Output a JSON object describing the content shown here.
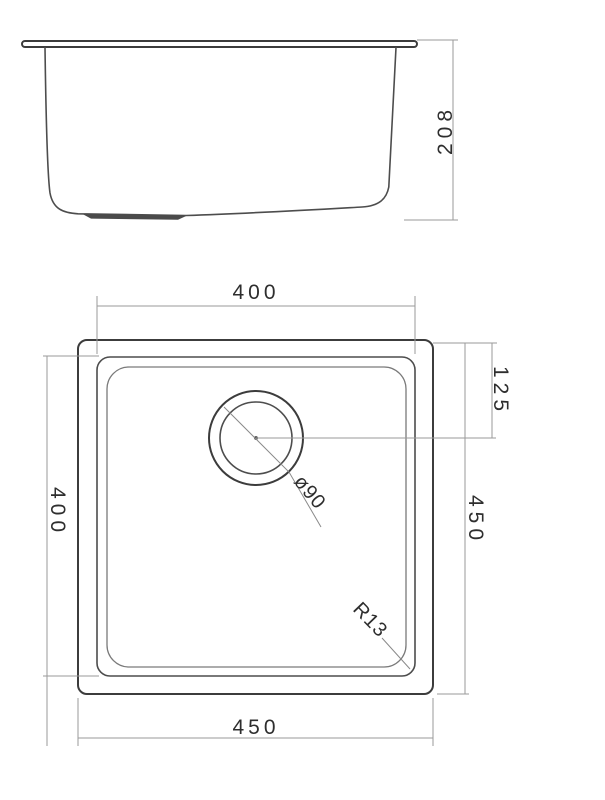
{
  "drawing": {
    "type": "technical-drawing",
    "subject": "square undermount sink, side elevation and plan view",
    "colors": {
      "background": "#ffffff",
      "object_line": "#4d4d4d",
      "dimension_line": "#9a9a9a",
      "text": "#2e2e2e"
    },
    "side_view": {
      "depth_dim": "208"
    },
    "plan_view": {
      "bowl_width_dim": "400",
      "bowl_length_dim": "400",
      "overall_width_dim": "450",
      "overall_length_dim": "450",
      "drain_offset_dim": "125",
      "drain_diameter_dim": "ø90",
      "corner_radius_dim": "R13"
    }
  }
}
